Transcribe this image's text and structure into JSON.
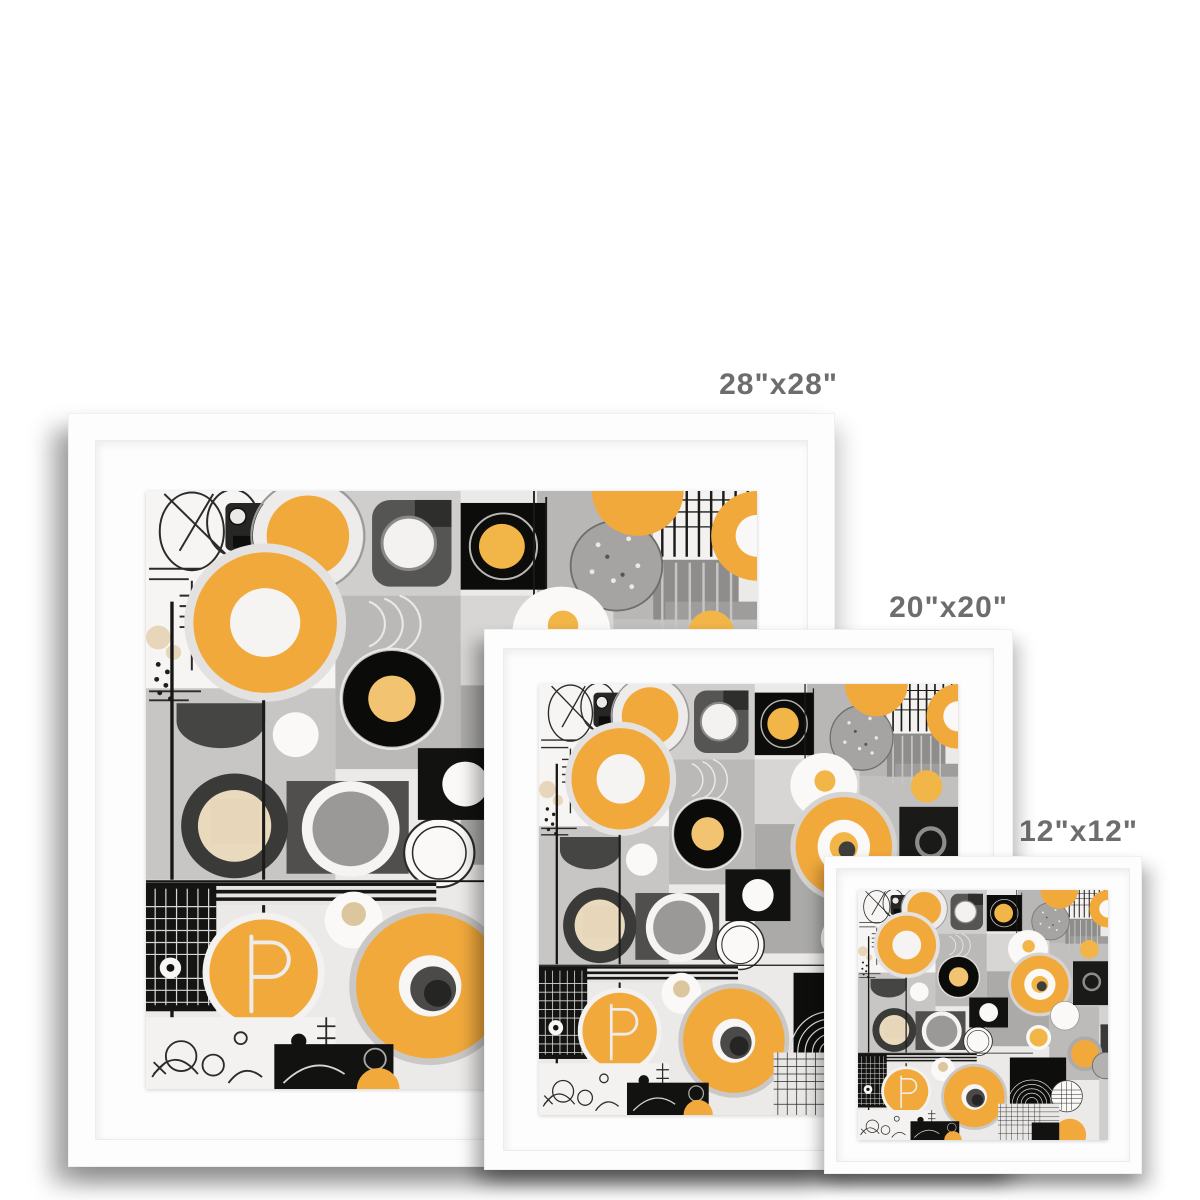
{
  "mockup": {
    "frames": [
      {
        "name": "framed-print-28x28",
        "size_label": "28\"x28\""
      },
      {
        "name": "framed-print-20x20",
        "size_label": "20\"x20\""
      },
      {
        "name": "framed-print-12x12",
        "size_label": "12\"x12\""
      }
    ],
    "label_color": "#6d6d6d",
    "frame_color": "#fdfdfd",
    "mat_color": "#fdfdfd",
    "background_color": "#ffffff",
    "artwork_palette": {
      "yellow": "#F2A93C",
      "yellow_light": "#F2C472",
      "cream_beige": "#EADABD",
      "black": "#121210",
      "dark_gray": "#4A4A48",
      "mid_gray": "#ABAAA8",
      "light_gray": "#D7D6D4",
      "off_white": "#FAF9F7"
    }
  }
}
